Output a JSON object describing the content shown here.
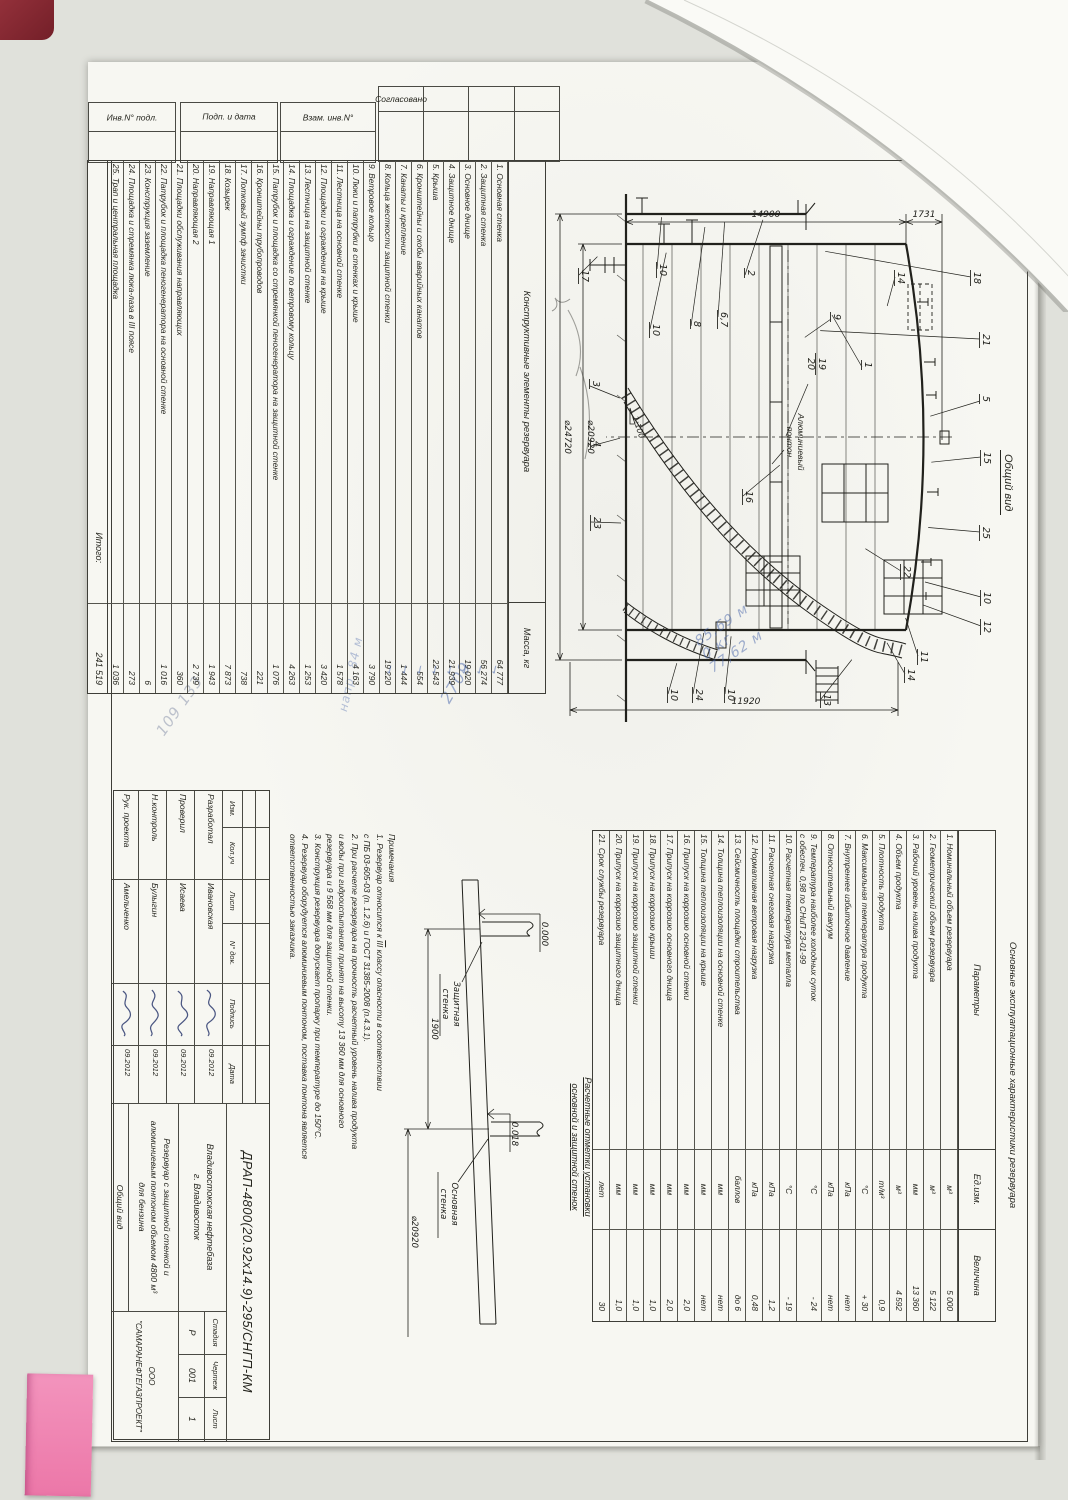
{
  "margin": {
    "soglasovano": "Согласовано",
    "inv": "Инв.N° подл.",
    "podp": "Подп. и дата",
    "vzam": "Взам. инв.N°"
  },
  "construction_table": {
    "title": "Конструктивные элементы резервуара",
    "mass_header": "Масса, кг",
    "rows": [
      {
        "name": "1.  Основная стенка",
        "mass": "64 777"
      },
      {
        "name": "2.  Защитная стенка",
        "mass": "56 274"
      },
      {
        "name": "3.  Основное днище",
        "mass": "19 020"
      },
      {
        "name": "4.  Защитное днище",
        "mass": "21 939"
      },
      {
        "name": "5.  Крыша",
        "mass": "22 543"
      },
      {
        "name": "6.  Кронштейны и скобы аварийных канатов",
        "mass": "554"
      },
      {
        "name": "7.  Канаты и крепление",
        "mass": "1 444"
      },
      {
        "name": "8.  Кольца жесткости защитной стенки",
        "mass": "19 220"
      },
      {
        "name": "9.  Ветровое кольцо",
        "mass": "3 790"
      },
      {
        "name": "10. Люки и патрубки в стенках и крыше",
        "mass": "4 163"
      },
      {
        "name": "11. Лестница на основной стенке",
        "mass": "1 578"
      },
      {
        "name": "12. Площадки и ограждения на крыше",
        "mass": "3 420"
      },
      {
        "name": "13. Лестница на защитной стенке",
        "mass": "1 253"
      },
      {
        "name": "14. Площадка и ограждение по ветровому кольцу",
        "mass": "4 263"
      },
      {
        "name": "15. Патрубок и площадка со стремянкой пеногенератора на защитной стенке",
        "mass": "1 076"
      },
      {
        "name": "16. Кронштейны трубопроводов",
        "mass": "221"
      },
      {
        "name": "17. Лотковый зумпф зачистки",
        "mass": "738"
      },
      {
        "name": "18. Козырек",
        "mass": "7 873"
      },
      {
        "name": "19. Направляющая 1",
        "mass": "1 943"
      },
      {
        "name": "20. Направляющая 2",
        "mass": "2 739"
      },
      {
        "name": "21. Площадки обслуживания направляющих",
        "mass": "360"
      },
      {
        "name": "22. Патрубок и площадка пеногенератора на основной стенке",
        "mass": "1 016"
      },
      {
        "name": "23. Конструкция заземление",
        "mass": "6"
      },
      {
        "name": "24. Площадка и стремянка люка-лаза в III поясе",
        "mass": "273"
      },
      {
        "name": "25. Трап и центральная площадка",
        "mass": "1 036"
      }
    ],
    "total_label": "Итого:",
    "total": "241 519"
  },
  "characteristics_table": {
    "title": "Основные эксплуатационные характеристики резервуара",
    "col_param": "Параметры",
    "col_unit": "Ед.изм.",
    "col_value": "Величина",
    "rows": [
      {
        "param": "1.  Номинальный объем резервуара",
        "param2": "",
        "unit": "м³",
        "value": "5 000"
      },
      {
        "param": "2.  Геометрический объем резервуара",
        "param2": "",
        "unit": "м³",
        "value": "5 122"
      },
      {
        "param": "3.  Рабочий уровень налива продукта",
        "param2": "",
        "unit": "мм",
        "value": "13 360"
      },
      {
        "param": "4.  Объем продукта",
        "param2": "",
        "unit": "м³",
        "value": "4 592"
      },
      {
        "param": "5.  Плотность продукта",
        "param2": "",
        "unit": "т/м³",
        "value": "0,9"
      },
      {
        "param": "6.  Максимальная температура продукта",
        "param2": "",
        "unit": "°С",
        "value": "+ 30"
      },
      {
        "param": "7.  Внутреннее избыточное давление",
        "param2": "",
        "unit": "кПа",
        "value": "нет"
      },
      {
        "param": "8.  Относительный вакуум",
        "param2": "",
        "unit": "кПа",
        "value": "нет"
      },
      {
        "param": "9.  Температура наиболее холодных суток",
        "param2": "с обеспеч. 0,98 по СНиП 23-01-99",
        "unit": "°С",
        "value": "- 24"
      },
      {
        "param": "10. Расчетная температура металла",
        "param2": "",
        "unit": "°С",
        "value": "- 19"
      },
      {
        "param": "11. Расчетная снеговая нагрузка",
        "param2": "",
        "unit": "кПа",
        "value": "1,2"
      },
      {
        "param": "12. Нормативная ветровая нагрузка",
        "param2": "",
        "unit": "кПа",
        "value": "0,48"
      },
      {
        "param": "13. Сейсмичность площадки строительства",
        "param2": "",
        "unit": "баллов",
        "value": "до 6"
      },
      {
        "param": "14. Толщина теплоизоляции на основной стенке",
        "param2": "",
        "unit": "мм",
        "value": "нет"
      },
      {
        "param": "15. Толщина теплоизоляции на крыше",
        "param2": "",
        "unit": "мм",
        "value": "нет"
      },
      {
        "param": "16. Припуск на коррозию основной стенки",
        "param2": "",
        "unit": "мм",
        "value": "2,0"
      },
      {
        "param": "17. Припуск на коррозию основного днища",
        "param2": "",
        "unit": "мм",
        "value": "2,0"
      },
      {
        "param": "18. Припуск на коррозию крыши",
        "param2": "",
        "unit": "мм",
        "value": "1,0"
      },
      {
        "param": "19. Припуск на коррозию защитной стенки",
        "param2": "",
        "unit": "мм",
        "value": "1,0"
      },
      {
        "param": "20. Припуск на коррозию защитного днища",
        "param2": "",
        "unit": "мм",
        "value": "1,0"
      },
      {
        "param": "21. Срок службы резервуара",
        "param2": "",
        "unit": "лет",
        "value": "30"
      }
    ]
  },
  "drawing": {
    "view_title": "Общий вид",
    "dims": {
      "height_shell": "14900",
      "height_roof": "1731",
      "dia_main": "⌀20920",
      "dia_outer": "⌀24720",
      "height_wall": "11920",
      "slope": "1:100"
    },
    "pontoon_label_1": "Алюминиевый",
    "pontoon_label_2": "понтон",
    "guide_callout": {
      "top": "19",
      "bottom": "20"
    },
    "callouts": [
      {
        "t": "17",
        "x": 206,
        "y": 448,
        "a": 225,
        "l": 26
      },
      {
        "t": "10",
        "x": 200,
        "y": 370,
        "a": 185,
        "l": 52
      },
      {
        "t": "2",
        "x": 206,
        "y": 282,
        "a": 198,
        "l": 58
      },
      {
        "t": "8",
        "x": 257,
        "y": 336,
        "a": 188,
        "l": 100
      },
      {
        "t": "6,7",
        "x": 248,
        "y": 309,
        "a": 184,
        "l": 95
      },
      {
        "t": "10",
        "x": 260,
        "y": 377,
        "a": 192,
        "l": 78
      },
      {
        "t": "14",
        "x": 208,
        "y": 132,
        "a": 15,
        "l": 30
      },
      {
        "t": "9",
        "x": 250,
        "y": 196,
        "a": 55,
        "l": 32
      },
      {
        "t": "1",
        "x": 298,
        "y": 165,
        "a": 150,
        "l": 60
      },
      {
        "t": "18",
        "x": 208,
        "y": 56,
        "a": 100,
        "l": 148
      },
      {
        "t": "21",
        "x": 270,
        "y": 47,
        "a": 93,
        "l": 160
      },
      {
        "t": "5",
        "x": 332,
        "y": 47,
        "a": 73,
        "l": 52
      },
      {
        "t": "15",
        "x": 388,
        "y": 46,
        "a": 84,
        "l": 50
      },
      {
        "t": "25",
        "x": 463,
        "y": 47,
        "a": 95,
        "l": 52
      },
      {
        "t": "10",
        "x": 528,
        "y": 46,
        "a": 105,
        "l": 58
      },
      {
        "t": "12",
        "x": 557,
        "y": 46,
        "a": 110,
        "l": 62
      },
      {
        "t": "11",
        "x": 587,
        "y": 109,
        "a": 162,
        "l": 40
      },
      {
        "t": "14",
        "x": 605,
        "y": 122,
        "a": 150,
        "l": 36
      },
      {
        "t": "22",
        "x": 502,
        "y": 126,
        "a": 122,
        "l": 42
      },
      {
        "t": "16",
        "x": 427,
        "y": 284,
        "a": 230,
        "l": 48
      },
      {
        "t": "13",
        "x": 630,
        "y": 206,
        "a": 218,
        "l": 50
      },
      {
        "t": "24",
        "x": 625,
        "y": 334,
        "a": 190,
        "l": 62
      },
      {
        "t": "10",
        "x": 625,
        "y": 302,
        "a": 186,
        "l": 58
      },
      {
        "t": "10",
        "x": 625,
        "y": 359,
        "a": 196,
        "l": 32
      },
      {
        "t": "3",
        "x": 317,
        "y": 437,
        "a": 292,
        "l": 32
      },
      {
        "t": "4",
        "x": 377,
        "y": 436,
        "a": 255,
        "l": 30
      },
      {
        "t": "23",
        "x": 453,
        "y": 436,
        "a": 272,
        "l": 30
      }
    ]
  },
  "calc_sketch": {
    "title_1": "Расчетные отметки установки",
    "title_2": "основной и защитной стенок",
    "wall_outer_1": "Защитная",
    "wall_outer_2": "стенка",
    "wall_main_1": "Основная",
    "wall_main_2": "стенка",
    "elev_outer": "0.000",
    "elev_main": "0.018",
    "gap_dim": "1900",
    "dia_dim": "⌀20920"
  },
  "notes": {
    "header": "Примечания",
    "line1_pre": "1. Резервуар относится к ",
    "line1_iii": "III",
    "line1_post": " классу опасности в соответствии",
    "line2": "с ПБ 03-605-03 (п. 1.2.6) и ГОСТ 31385-2008 (п.4.3.1).",
    "line3": "2. При расчете резервуара на прочность расчетный уровень налива продукта",
    "line4": "и воды при гидроиспытаниях принят на высоту 13 360 мм для основного",
    "line5": "резервуара и 9 568 мм для защитной стенки.",
    "line6": "3. Конструкция резервуара допускает пропарку при температуре до 150°С.",
    "line7": "4. Резервуар оборудуется алюминиевым понтоном, поставка понтона является",
    "line8": "ответственностью заказчика."
  },
  "title_block": {
    "code": "ДРАП-4800(20.92х14.9)-295/СНГП-КМ",
    "cols": {
      "izm": "Изм.",
      "kol": "Кол.уч",
      "list": "Лист",
      "ndok": "N° док.",
      "podp": "Подпись",
      "data": "Дата"
    },
    "staff": [
      {
        "role": "Разработал",
        "name": "Ивановская",
        "date": "09.2012"
      },
      {
        "role": "Проверил",
        "name": "Исаева",
        "date": "09.2012"
      },
      {
        "role": "Н.контроль",
        "name": "Булыгин",
        "date": "09.2012"
      },
      {
        "role": "Рук. проекта",
        "name": "Амельченко",
        "date": "09.2012"
      }
    ],
    "org_line1": "Владивостокская нефтебаза",
    "org_line2": "г. Владивосток",
    "subject_line1": "Резервуар с защитной стенкой и",
    "subject_line2": "алюминиевым понтоном объемом 4800 м³",
    "subject_line3": "для бензина",
    "stage_label": "Стадия",
    "drawing_label": "Чертеж",
    "sheet_label": "Лист",
    "stage": "Р",
    "drawing_no": "001",
    "sheet_no": "1",
    "view_label": "Общий вид",
    "company_line1": "ООО",
    "company_line2": "\"САМАРАНЕФТЕГАЗПРОЕКТ\""
  },
  "annotations": {
    "ink_color": "#4663a8",
    "check": "✓",
    "checks": [
      {
        "x": 603,
        "y": 536
      },
      {
        "x": 603,
        "y": 551
      },
      {
        "x": 603,
        "y": 566
      },
      {
        "x": 603,
        "y": 581
      },
      {
        "x": 603,
        "y": 596
      },
      {
        "x": 603,
        "y": 611
      },
      {
        "x": 603,
        "y": 626
      },
      {
        "x": 603,
        "y": 641
      }
    ],
    "n2709": "2709",
    "n109": "109 133",
    "n84": "напр. 84 м",
    "t1": "85,69 м",
    "t2": "0 кг",
    "t3": "77,62 м"
  }
}
